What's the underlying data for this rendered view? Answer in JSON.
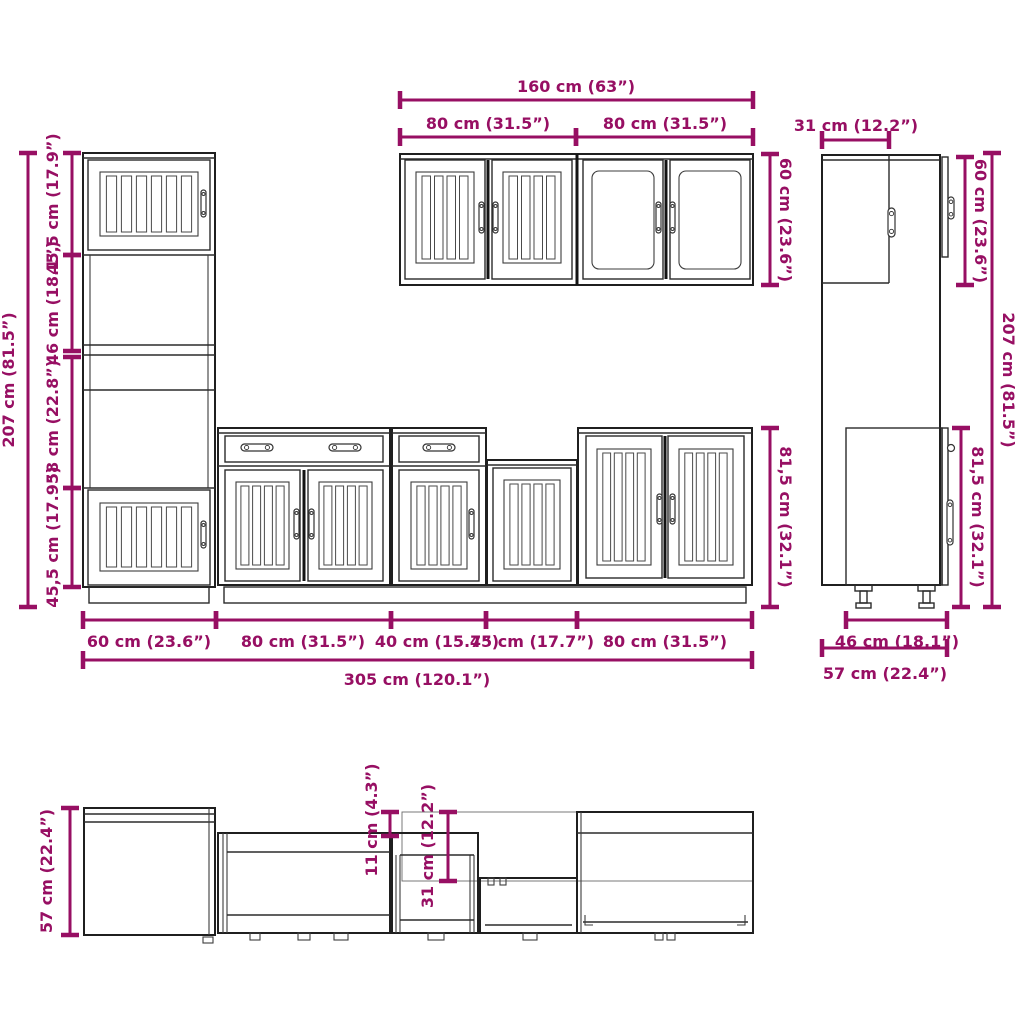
{
  "colors": {
    "dimension_accent": "#970F63",
    "line_art": "#1f1f1f",
    "background": "#ffffff"
  },
  "front": {
    "width_total_top": "160 cm (63”)",
    "width_80_left": "80 cm (31.5”)",
    "width_80_right": "80 cm (31.5”)",
    "height_wall": "60 cm (23.6”)",
    "height_total": "207 cm (81.5”)",
    "height_base": "81,5 cm (32.1”)",
    "sect_45_top": "45,5 cm (17.9”)",
    "sect_46": "46 cm (18.1”)",
    "sect_58": "58 cm (22.8”)",
    "sect_45_bottom": "45,5 cm (17.9”)",
    "w_60": "60 cm (23.6”)",
    "w_80a": "80 cm (31.5”)",
    "w_40": "40 cm (15.7”)",
    "w_45": "45 cm (17.7”)",
    "w_80b": "80 cm (31.5”)",
    "width_total": "305 cm (120.1”)"
  },
  "side": {
    "depth_wall": "31 cm (12.2”)",
    "height_wall": "60 cm (23.6”)",
    "height_total": "207 cm (81.5”)",
    "height_base": "81,5 cm (32.1”)",
    "depth_base": "46 cm (18.1”)",
    "depth_total": "57 cm (22.4”)"
  },
  "plan": {
    "depth_total": "57 cm (22.4”)",
    "offset_wall": "11 cm (4.3”)",
    "depth_wall": "31 cm (12.2”)"
  }
}
